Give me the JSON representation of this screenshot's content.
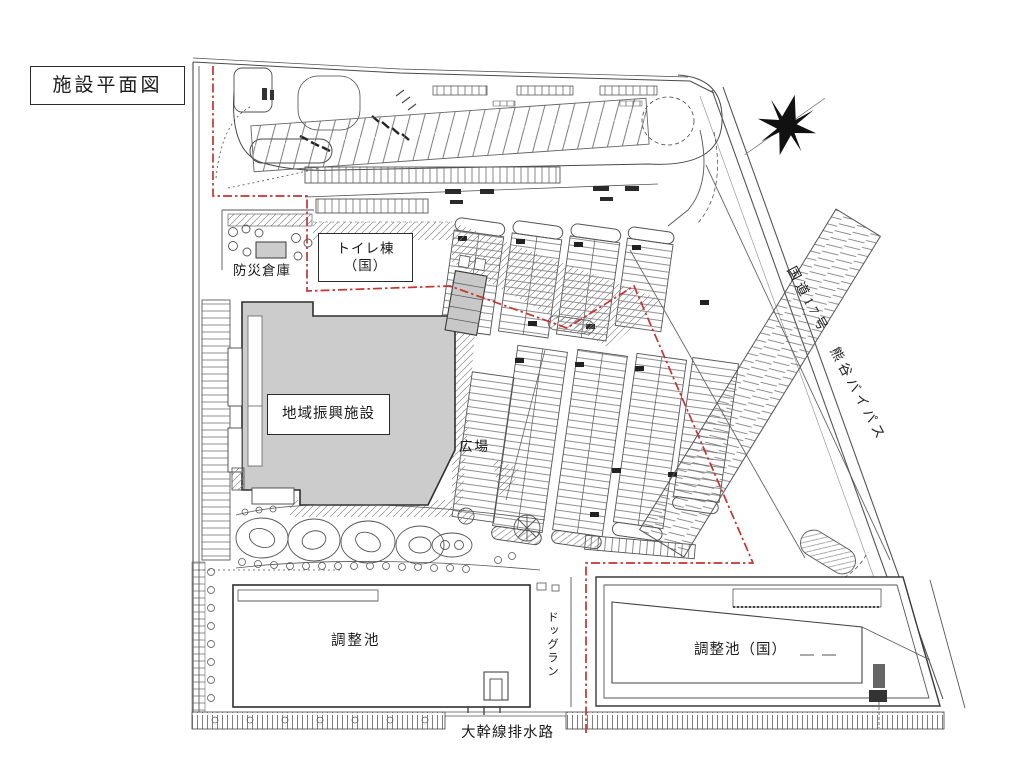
{
  "title": "施設平面図",
  "labels": {
    "bousai": "防災倉庫",
    "toilet_line1": "トイレ棟",
    "toilet_line2": "（国）",
    "chiiki": "地域振興施設",
    "hiroba": "広場",
    "pond_left": "調整池",
    "dogrun": "ドッグラン",
    "pond_right": "調整池（国）",
    "drainage": "大幹線排水路",
    "road": "国道17号　熊谷バイパス"
  },
  "icons": {
    "compass": "compass-rose-north-arrow"
  },
  "colors": {
    "boundary_red": "#c43431",
    "building_gray": "#cccccc",
    "linework": "#4a4a4a"
  }
}
